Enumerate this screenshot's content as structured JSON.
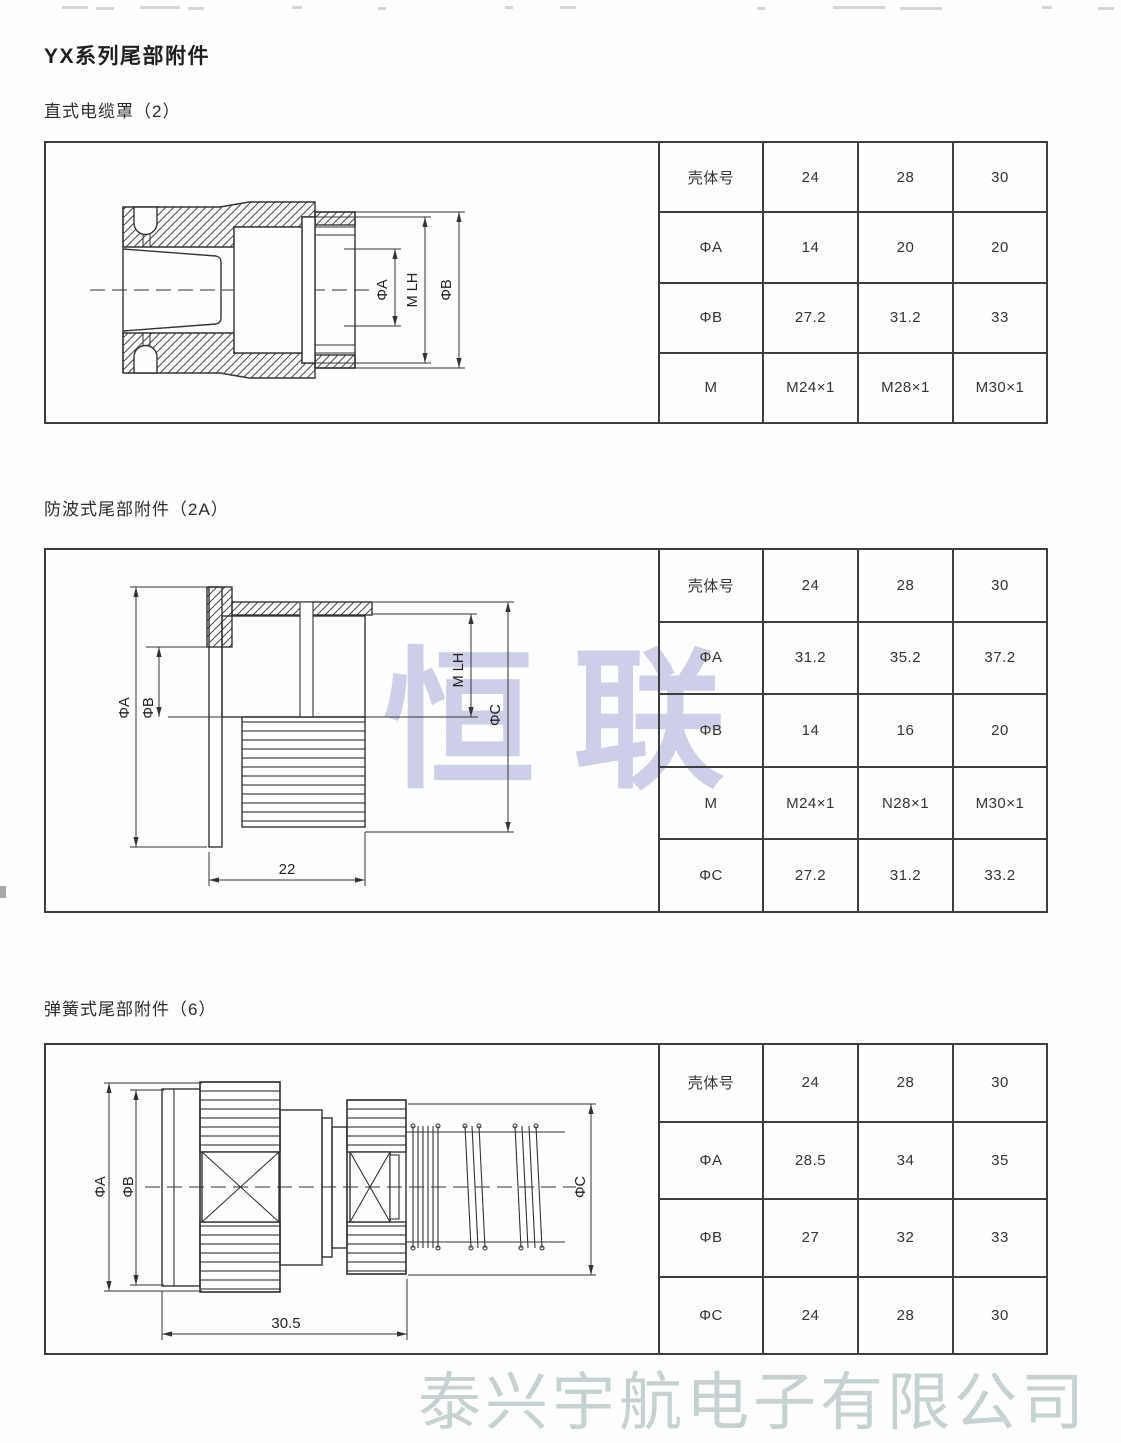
{
  "page": {
    "title": "YX系列尾部附件",
    "center_watermark": "恒联",
    "bottom_watermark": "泰兴宇航电子有限公司"
  },
  "sections": {
    "s1": {
      "heading": "直式电缆罩（2）",
      "dims": {
        "phiA": "ΦA",
        "mlh": "M LH",
        "phiB": "ΦB"
      },
      "table": {
        "r0": [
          "壳体号",
          "24",
          "28",
          "30"
        ],
        "r1": [
          "ΦA",
          "14",
          "20",
          "20"
        ],
        "r2": [
          "ΦB",
          "27.2",
          "31.2",
          "33"
        ],
        "r3": [
          "M",
          "M24×1",
          "M28×1",
          "M30×1"
        ]
      }
    },
    "s2": {
      "heading": "防波式尾部附件（2A）",
      "dims": {
        "phiA": "ΦA",
        "phiB": "ΦB",
        "mlh": "M LH",
        "phiC": "ΦC",
        "length": "22"
      },
      "table": {
        "r0": [
          "壳体号",
          "24",
          "28",
          "30"
        ],
        "r1": [
          "ΦA",
          "31.2",
          "35.2",
          "37.2"
        ],
        "r2": [
          "ΦB",
          "14",
          "16",
          "20"
        ],
        "r3": [
          "M",
          "M24×1",
          "N28×1",
          "M30×1"
        ],
        "r4": [
          "ΦC",
          "27.2",
          "31.2",
          "33.2"
        ]
      }
    },
    "s3": {
      "heading": "弹簧式尾部附件（6）",
      "dims": {
        "phiA": "ΦA",
        "phiB": "ΦB",
        "phiC": "ΦC",
        "length": "30.5"
      },
      "table": {
        "r0": [
          "壳体号",
          "24",
          "28",
          "30"
        ],
        "r1": [
          "ΦA",
          "28.5",
          "34",
          "35"
        ],
        "r2": [
          "ΦB",
          "27",
          "32",
          "33"
        ],
        "r3": [
          "ΦC",
          "24",
          "28",
          "30"
        ]
      }
    }
  }
}
